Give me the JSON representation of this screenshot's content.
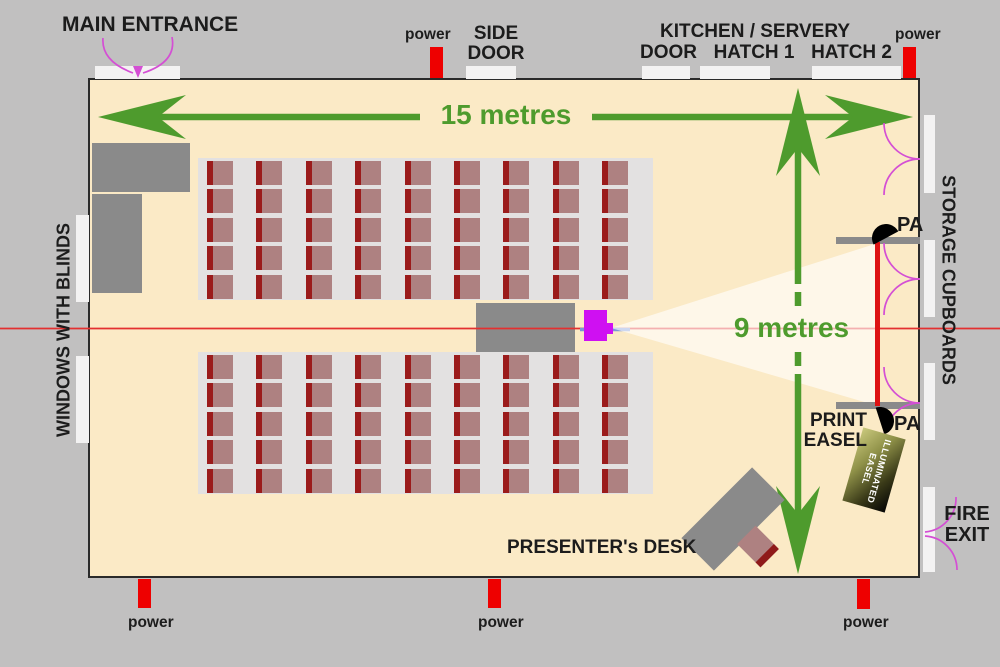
{
  "labels": {
    "main_entrance": "MAIN ENTRANCE",
    "side_door": [
      "SIDE",
      "DOOR"
    ],
    "kitchen_servery": "KITCHEN / SERVERY",
    "kitchen_door": "DOOR",
    "hatch_1": "HATCH 1",
    "hatch_2": "HATCH 2",
    "power": "power",
    "windows": "WINDOWS WITH BLINDS",
    "storage": "STORAGE CUPBOARDS",
    "fire_exit": [
      "FIRE",
      "EXIT"
    ],
    "room_width": "15 metres",
    "room_depth": "9 metres",
    "pa": "PA",
    "print_easel": [
      "PRINT",
      "EASEL"
    ],
    "illuminated_easel": [
      "ILLUMINATED",
      "EASEL"
    ],
    "presenter_desk": "PRESENTER's DESK"
  },
  "seating": {
    "blocks": 2,
    "rows_per_block": 5,
    "seats_per_row": 9,
    "total_seats": 90
  },
  "colors": {
    "background": "#c1c0c0",
    "room_floor": "#fbeac6",
    "dimension_green": "#4e9b2d",
    "door_swing_magenta": "#d44fd4",
    "power_red": "#ee0000",
    "screen_red": "#dd1313",
    "projector_magenta": "#cf10f2",
    "cable_blue": "#7b96d8",
    "chair_seat": "#ae8181",
    "chair_back": "#9b1b1b",
    "furniture_gray": "#8a8a8a"
  }
}
